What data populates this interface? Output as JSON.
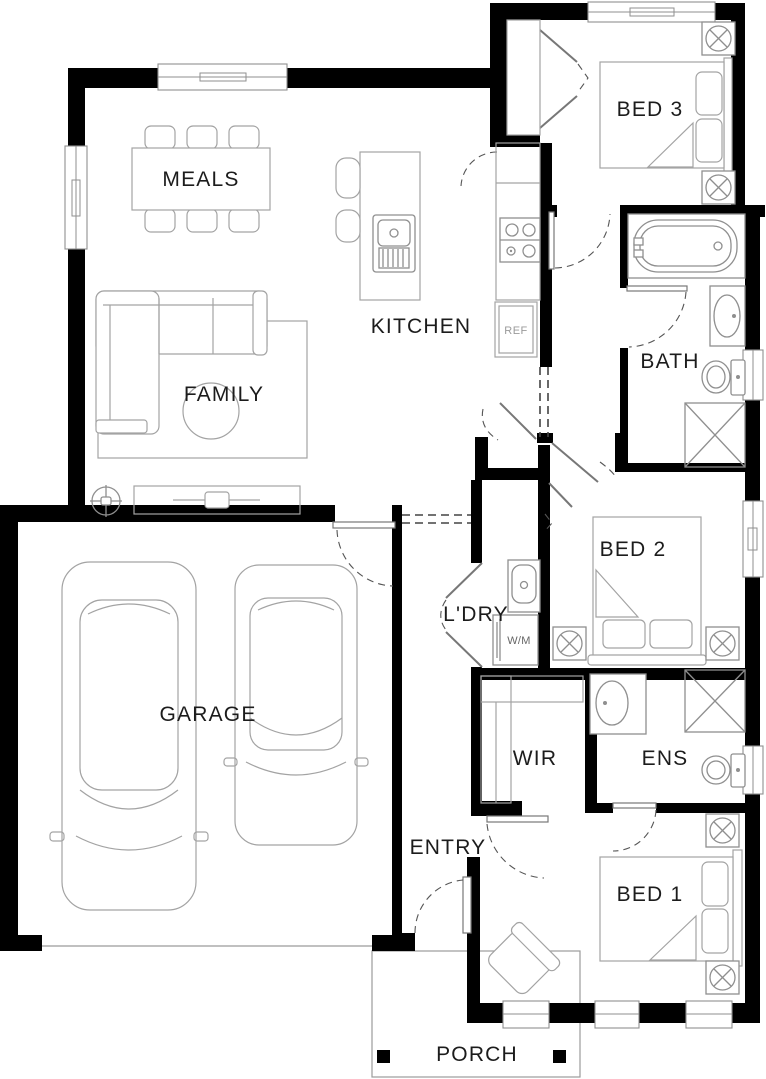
{
  "floorplan": {
    "rooms": {
      "meals": {
        "label": "MEALS"
      },
      "kitchen": {
        "label": "KITCHEN"
      },
      "family": {
        "label": "FAMILY"
      },
      "garage": {
        "label": "GARAGE"
      },
      "laundry": {
        "label": "L'DRY"
      },
      "wir": {
        "label": "WIR"
      },
      "ens": {
        "label": "ENS"
      },
      "entry": {
        "label": "ENTRY"
      },
      "bath": {
        "label": "BATH"
      },
      "bed1": {
        "label": "BED 1"
      },
      "bed2": {
        "label": "BED 2"
      },
      "bed3": {
        "label": "BED 3"
      },
      "porch": {
        "label": "PORCH"
      }
    },
    "appliances": {
      "fridge": "REF",
      "washer": "W/M"
    },
    "colors": {
      "wall": "#000000",
      "furniture_line": "#a3a3a3",
      "label_text": "#1c1c1c",
      "appliance_text": "#9a9a9a",
      "background": "#ffffff"
    }
  }
}
